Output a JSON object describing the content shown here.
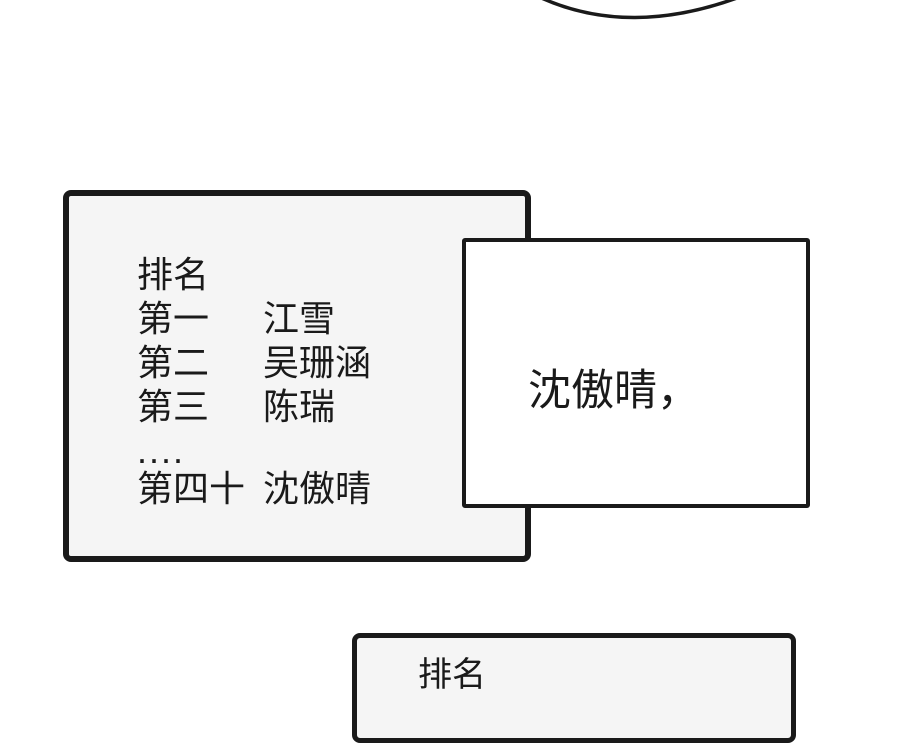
{
  "colors": {
    "ink": "#1a1a1a",
    "panel_fill": "#f5f5f5",
    "callout_fill": "#ffffff",
    "page_bg": "#ffffff"
  },
  "ranking_panel": {
    "title": "排名",
    "rows": [
      {
        "rank": "第一",
        "name": "江雪"
      },
      {
        "rank": "第二",
        "name": "吴珊涵"
      },
      {
        "rank": "第三",
        "name": "陈瑞"
      }
    ],
    "ellipsis": "....",
    "last_row": {
      "rank": "第四十",
      "name": "沈傲晴"
    }
  },
  "callout_box": {
    "text": "沈傲晴，"
  },
  "bottom_panel": {
    "title": "排名"
  }
}
